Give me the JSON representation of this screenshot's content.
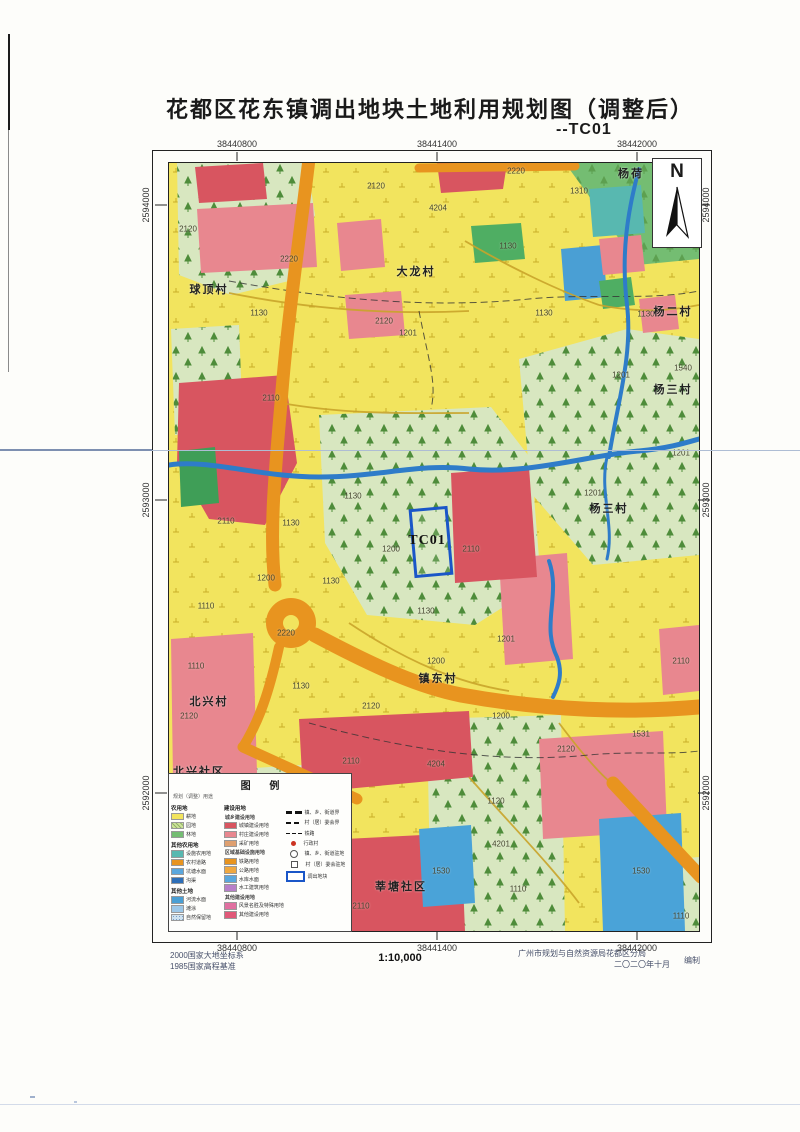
{
  "page": {
    "title": "花都区花东镇调出地块土地利用规划图（调整后）",
    "subtitle": "--TC01"
  },
  "map": {
    "north_label": "N",
    "x_ticks": [
      "38440800",
      "38441400",
      "38442000"
    ],
    "y_ticks": [
      "2594000",
      "2593000",
      "2592000"
    ],
    "parcel": {
      "label": "TC01",
      "x": 258,
      "y": 378
    },
    "village_labels": [
      {
        "text": "大龙村",
        "x": 247,
        "y": 108
      },
      {
        "text": "球顶村",
        "x": 40,
        "y": 126
      },
      {
        "text": "杨荷",
        "x": 462,
        "y": 10
      },
      {
        "text": "杨二村",
        "x": 504,
        "y": 148
      },
      {
        "text": "杨三村",
        "x": 504,
        "y": 226
      },
      {
        "text": "杨三村",
        "x": 440,
        "y": 345
      },
      {
        "text": "镇东村",
        "x": 269,
        "y": 515
      },
      {
        "text": "北兴村",
        "x": 40,
        "y": 538
      },
      {
        "text": "北兴社区",
        "x": 30,
        "y": 608
      },
      {
        "text": "莘塘社区",
        "x": 232,
        "y": 723
      }
    ],
    "code_labels": [
      {
        "text": "2220",
        "x": 347,
        "y": 8
      },
      {
        "text": "2120",
        "x": 207,
        "y": 23
      },
      {
        "text": "1310",
        "x": 410,
        "y": 28
      },
      {
        "text": "4204",
        "x": 269,
        "y": 45
      },
      {
        "text": "1130",
        "x": 339,
        "y": 83
      },
      {
        "text": "2120",
        "x": 19,
        "y": 66
      },
      {
        "text": "2220",
        "x": 120,
        "y": 96
      },
      {
        "text": "1130",
        "x": 90,
        "y": 150
      },
      {
        "text": "1130",
        "x": 375,
        "y": 150
      },
      {
        "text": "1130",
        "x": 477,
        "y": 151
      },
      {
        "text": "2120",
        "x": 215,
        "y": 158
      },
      {
        "text": "1201",
        "x": 239,
        "y": 170
      },
      {
        "text": "1201",
        "x": 452,
        "y": 212
      },
      {
        "text": "1540",
        "x": 514,
        "y": 205
      },
      {
        "text": "2110",
        "x": 102,
        "y": 235
      },
      {
        "text": "1201",
        "x": 512,
        "y": 290
      },
      {
        "text": "1130",
        "x": 184,
        "y": 333
      },
      {
        "text": "1201",
        "x": 424,
        "y": 330
      },
      {
        "text": "2110",
        "x": 57,
        "y": 358
      },
      {
        "text": "1130",
        "x": 122,
        "y": 360
      },
      {
        "text": "1200",
        "x": 222,
        "y": 386
      },
      {
        "text": "2110",
        "x": 302,
        "y": 386
      },
      {
        "text": "1200",
        "x": 97,
        "y": 415
      },
      {
        "text": "1130",
        "x": 162,
        "y": 418
      },
      {
        "text": "1110",
        "x": 37,
        "y": 443
      },
      {
        "text": "1130",
        "x": 257,
        "y": 448
      },
      {
        "text": "2220",
        "x": 117,
        "y": 470
      },
      {
        "text": "1201",
        "x": 337,
        "y": 476
      },
      {
        "text": "1200",
        "x": 267,
        "y": 498
      },
      {
        "text": "2110",
        "x": 512,
        "y": 498
      },
      {
        "text": "1110",
        "x": 27,
        "y": 503
      },
      {
        "text": "1130",
        "x": 132,
        "y": 523
      },
      {
        "text": "2120",
        "x": 202,
        "y": 543
      },
      {
        "text": "2120",
        "x": 20,
        "y": 553
      },
      {
        "text": "1200",
        "x": 332,
        "y": 553
      },
      {
        "text": "1531",
        "x": 472,
        "y": 571
      },
      {
        "text": "2120",
        "x": 397,
        "y": 586
      },
      {
        "text": "2110",
        "x": 182,
        "y": 598
      },
      {
        "text": "4204",
        "x": 267,
        "y": 601
      },
      {
        "text": "1120",
        "x": 327,
        "y": 638
      },
      {
        "text": "4201",
        "x": 332,
        "y": 681
      },
      {
        "text": "1530",
        "x": 272,
        "y": 708
      },
      {
        "text": "1530",
        "x": 472,
        "y": 708
      },
      {
        "text": "2110",
        "x": 192,
        "y": 743
      },
      {
        "text": "1110",
        "x": 349,
        "y": 726
      },
      {
        "text": "1110",
        "x": 512,
        "y": 753
      }
    ]
  },
  "legend": {
    "title": "图 例",
    "note": "规划（调整）用途",
    "col1": [
      {
        "type": "header",
        "label": "农用地"
      },
      {
        "type": "item",
        "label": "耕地",
        "color": "#f2e45e"
      },
      {
        "type": "item",
        "label": "园地",
        "color": "#cfe39a",
        "pattern": "hatch"
      },
      {
        "type": "item",
        "label": "林地",
        "color": "#74bd72"
      },
      {
        "type": "header",
        "label": "其他农用地"
      },
      {
        "type": "item",
        "label": "设施农用地",
        "color": "#58b8b0"
      },
      {
        "type": "item",
        "label": "农村道路",
        "color": "#e8941f"
      },
      {
        "type": "item",
        "label": "坑塘水面",
        "color": "#5aa7dd"
      },
      {
        "type": "item",
        "label": "沟渠",
        "color": "#2e6fb8"
      },
      {
        "type": "header",
        "label": "其他土地"
      },
      {
        "type": "item",
        "label": "河流水面",
        "color": "#4a9fd4"
      },
      {
        "type": "item",
        "label": "滩涂",
        "color": "#9cc7e8"
      },
      {
        "type": "item",
        "label": "自然保留地",
        "color": "#cfe2f0",
        "pattern": "dots"
      }
    ],
    "col2": [
      {
        "type": "header",
        "label": "建设用地"
      },
      {
        "type": "subheader",
        "label": "城乡建设用地"
      },
      {
        "type": "item",
        "label": "城镇建设用地",
        "color": "#d85560"
      },
      {
        "type": "item",
        "label": "村庄建设用地",
        "color": "#e8878f"
      },
      {
        "type": "item",
        "label": "采矿用地",
        "color": "#dfa070"
      },
      {
        "type": "subheader",
        "label": "区域基础设施用地"
      },
      {
        "type": "item",
        "label": "铁路用地",
        "color": "#e8941f"
      },
      {
        "type": "item",
        "label": "公路用地",
        "color": "#f0a840"
      },
      {
        "type": "item",
        "label": "水库水面",
        "color": "#5aa7dd"
      },
      {
        "type": "item",
        "label": "水工建筑用地",
        "color": "#b77fc9"
      },
      {
        "type": "subheader",
        "label": "其他建设用地"
      },
      {
        "type": "item",
        "label": "风景名胜及特殊用地",
        "color": "#e070a0"
      },
      {
        "type": "item",
        "label": "其他建设用地",
        "color": "#e05878"
      }
    ],
    "symbols": [
      {
        "symbol": "dash-thick",
        "label": "镇、乡、街道界"
      },
      {
        "symbol": "dash-med",
        "label": "村（居）委会界"
      },
      {
        "symbol": "dash-thin",
        "label": "铁路"
      },
      {
        "symbol": "dot-red",
        "label": "行政村"
      },
      {
        "symbol": "mark-town",
        "label": "镇、乡、街道驻地"
      },
      {
        "symbol": "mark-village",
        "label": "村（居）委会驻地"
      },
      {
        "symbol": "rect-blue",
        "label": "调出地块"
      }
    ]
  },
  "footer": {
    "datum_line1": "2000国家大地坐标系",
    "datum_line2": "1985国家高程基准",
    "scale": "1:10,000",
    "credit_line1": "广州市规划与自然资源局花都区分局",
    "credit_mark": "编制",
    "credit_line2": "二〇二〇年十月"
  },
  "colors": {
    "parcel_outline": "#1a56c8",
    "cropland": "#f2e45e",
    "orchard_pattern": "#d8e7c0",
    "forest": "#74bd72",
    "town_construction": "#d85560",
    "village_construction": "#e8878f",
    "road": "#e8941f",
    "river": "#2e7cc9",
    "water": "#4aa3d8"
  }
}
